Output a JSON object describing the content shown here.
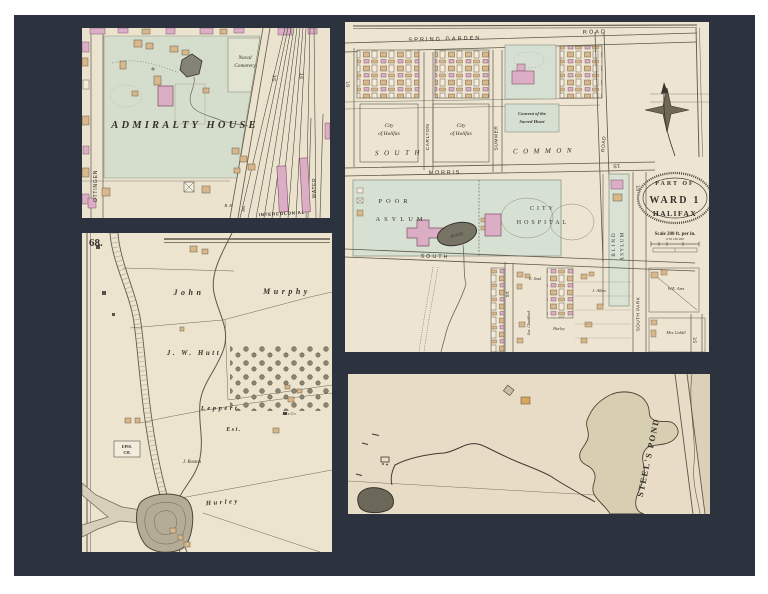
{
  "scene": {
    "mat_color": "#2d333e",
    "frame_color": "#ffffff",
    "paper_color": "#ece3cf",
    "park_green": "#d5ddcc",
    "building_pink": "#dcaec6",
    "building_tan": "#d8b78a"
  },
  "admiralty": {
    "title": "ADMIRALTY HOUSE",
    "naval_cemetery_line1": "Naval",
    "naval_cemetery_line2": "Cemetery",
    "street_gottingen": "OTTINGEN",
    "street_st_1": "ST.",
    "street_st_2": "ST.",
    "street_water": "WATER",
    "street_lockman": "AN",
    "railway": "INTERCOLONIAL",
    "label_bh": "B. H."
  },
  "ward1": {
    "street_spring_garden": "SPRING GARDEN",
    "street_road_top": "ROAD",
    "street_st_left": "ST.",
    "street_carlton": "CARLTON",
    "street_summer": "SUMMER",
    "street_road_right": "ROAD",
    "street_morris": "MORRIS",
    "street_morris_st": "ST.",
    "street_south": "SOUTH",
    "street_south_park": "SOUTH PARK",
    "street_st_mid": "ST.",
    "street_st_blind": "ST.",
    "street_st_corner": "ST.",
    "south_common_word1": "SOUTH",
    "south_common_word2": "COMMON",
    "city_block_a_line1": "City",
    "city_block_a_line2": "of Halifax",
    "city_block_b_line1": "City",
    "city_block_b_line2": "of Halifax",
    "convent_line1": "Convent of the",
    "convent_line2": "Sacred Heart",
    "poor": "POOR",
    "poor_asylum": "ASYLUM",
    "pond": "POND",
    "city": "CITY",
    "hospital": "HOSPITAL",
    "blind": "BLIND",
    "blind_asylum": "ASYLUM",
    "cartouche_part_of": "PART OF",
    "cartouche_ward": "WARD 1",
    "cartouche_halifax": "HALIFAX",
    "cartouche_scale": "Scale 200 ft. per in.",
    "cartouche_ticks": "0  50 100      200",
    "name_e_saul": "E. Saul",
    "name_j_allen": "J. Allen",
    "name_we_artz": "W.E. Artz",
    "name_mrs_cahill": "Mrs Cahill",
    "name_chaddock": "Jas. Chaddock",
    "name_hurley": "Hurley"
  },
  "murphy": {
    "page_number": "68.",
    "name_john": "John",
    "name_murphy": "Murphy",
    "name_jw_hutt": "J. W. Hutt",
    "name_leppert": "Leppert",
    "name_leppert_est": "Est.",
    "name_mrs_co": "Mrs Co",
    "name_epis_line1": "EPIS.",
    "name_epis_line2": "CH.",
    "name_j_boston": "J. Boston",
    "name_hurley": "Hurley"
  },
  "steels": {
    "pond_label": "STEEL'S POND"
  }
}
